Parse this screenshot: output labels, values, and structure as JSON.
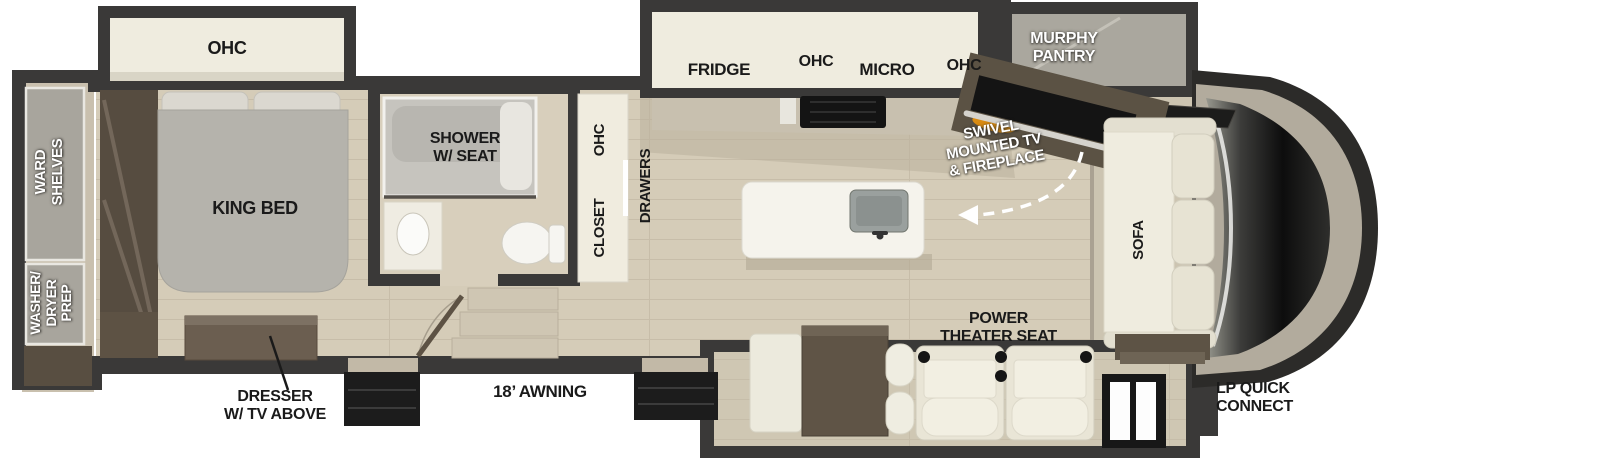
{
  "diagram_type": "rv-fifth-wheel-floorplan",
  "labels": {
    "bedroom_ohc": "OHC",
    "ward_shelves": "WARD\nSHELVES",
    "washer_dryer_prep": "WASHER/\nDRYER\nPREP",
    "king_bed": "KING BED",
    "dresser": "DRESSER\nW/ TV ABOVE",
    "shower": "SHOWER\nW/ SEAT",
    "closet": "CLOSET",
    "closet_ohc": "OHC",
    "drawers": "DRAWERS",
    "fridge": "FRIDGE",
    "kitchen_ohc_left": "OHC",
    "micro": "MICRO",
    "kitchen_ohc_right": "OHC",
    "murphy_pantry": "MURPHY\nPANTRY",
    "swivel_tv_fireplace": "SWIVEL\nMOUNTED TV\n& FIREPLACE",
    "sofa": "SOFA",
    "power_theater_seat": "POWER\nTHEATER SEAT",
    "awning": "18’ AWNING",
    "lp_quick_connect": "LP QUICK\nCONNECT"
  },
  "colors": {
    "wall": "#3a3938",
    "floor": "#d5ccb8",
    "slide_interior": "#efecdf",
    "gray_cabinet": "#a8a59d",
    "bed": "#b5b3ac",
    "wood_brown": "#5f5446",
    "white_furniture": "#efecdf",
    "black_fixture": "#161616",
    "fireplace_flame": "#e8920e",
    "label_dark": "#1a1a1a",
    "label_white": "#ffffff"
  }
}
